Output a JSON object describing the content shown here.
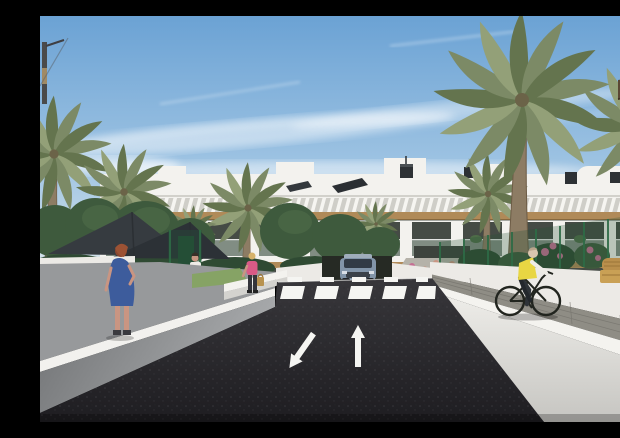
{
  "scene": {
    "title": "New-build apartment complex — street rendering",
    "description": "Architectural 3D rendering: white two-storey apartment block with timber pergola bands and balconies behind palm trees, a dark asphalt street with a zebra crossing and two lane arrows, a grey SUV at the garage entrance, a woman in a blue dress on the left sidewalk, a woman in pink with a handbag, pedestrians at the entrance walkway and a cyclist in a yellow hi-vis vest riding along the right-hand white wall under a sunny blue sky with wispy clouds."
  },
  "objects": {
    "building": {
      "label": "white apartment block with wood pergola bands and balconies",
      "floors_visible": 2
    },
    "foreground_building": {
      "label": "near building corner with green glass balconies and brown slabs"
    },
    "vehicles": [
      {
        "label": "grey SUV at garage entrance"
      },
      {
        "label": "bicycle"
      }
    ],
    "people": [
      {
        "label": "woman with red hair in blue dress",
        "location": "left sidewalk"
      },
      {
        "label": "man in white t-shirt",
        "location": "path behind left wall"
      },
      {
        "label": "woman in pink top with handbag",
        "location": "near centre-left wall"
      },
      {
        "label": "pedestrians",
        "location": "building entrance walkway"
      },
      {
        "label": "cyclist in yellow hi-vis vest",
        "location": "right-hand walkway"
      }
    ],
    "road": {
      "surface": "dark asphalt",
      "markings": [
        "zebra crosswalk",
        "arrow toward viewer (left lane)",
        "arrow away from viewer (right lane)"
      ],
      "crosswalk_stripes": 5
    },
    "vegetation": [
      "palm trees",
      "clipped hedges",
      "green mesh fence",
      "pink bougainvillea"
    ],
    "shade_sails": 2
  },
  "palette": {
    "sky_top": "#6ba2d4",
    "sky_mid": "#9cc2e2",
    "sky_horizon": "#dbe6ec",
    "building_white": "#f3f2ee",
    "building_shadow": "#d8d7d1",
    "wood": "#b08a58",
    "balcony_dark": "#454b45",
    "glass_teal": "#85a99c",
    "palm_green": "#7c8a66",
    "palm_green_dark": "#64744e",
    "palm_trunk": "#8d7c64",
    "tree_green": "#3e5a3d",
    "hedge_green": "#2f4a33",
    "flower_pink": "#c56f93",
    "asphalt_light": "#38373b",
    "asphalt_dark": "#1e1d21",
    "road_mark": "#f5f5f2",
    "sidewalk_gray": "#97999b",
    "wall_light": "#eceae6",
    "paver_gray": "#8f8d85",
    "car_body": "#8295a9",
    "vest_yellow": "#e8d643",
    "dress_blue": "#3d5c9c",
    "top_pink": "#d95a86",
    "skin": "#c99582",
    "fence_green": "#2e6b46",
    "sail_dark": "#363b40"
  }
}
